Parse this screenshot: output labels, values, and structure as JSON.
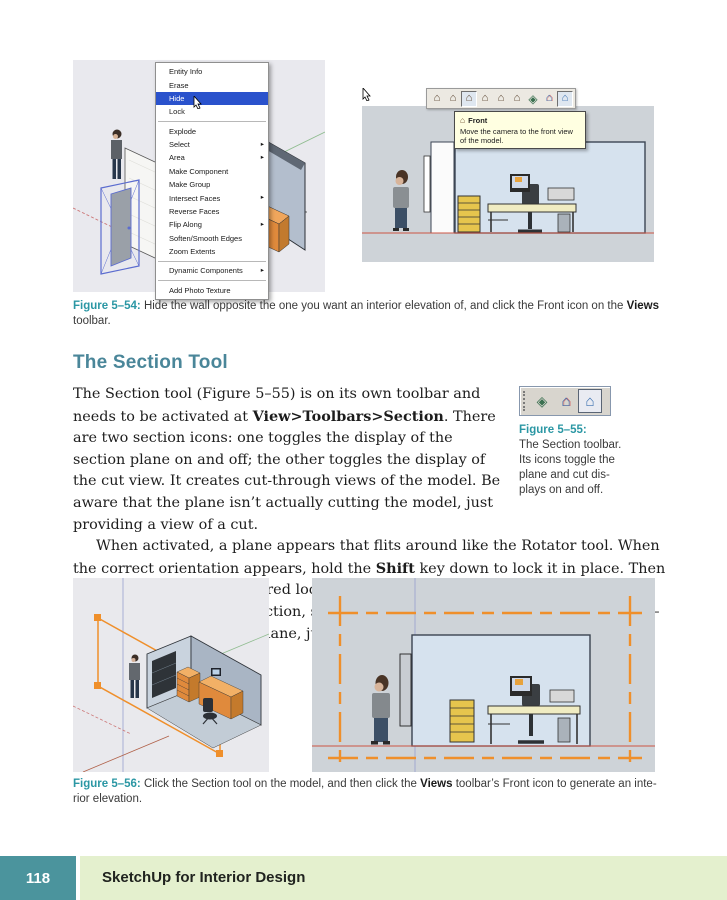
{
  "colors": {
    "accent_teal": "#2B97A4",
    "heading_teal": "#4A8699",
    "footer_teal": "#4B949D",
    "footer_green": "#E4F0CE",
    "menu_highlight": "#2A52CC",
    "tooltip_bg": "#FFFFE1",
    "section_plane_orange": "#EF8F2B",
    "desk_orange": "#E08A3C"
  },
  "figure54": {
    "context_menu": {
      "items": [
        {
          "label": "Entity Info"
        },
        {
          "label": "Erase"
        },
        {
          "label": "Hide",
          "highlighted": true
        },
        {
          "label": "Lock"
        },
        {
          "separator": true
        },
        {
          "label": "Explode"
        },
        {
          "label": "Select",
          "submenu": true
        },
        {
          "label": "Area",
          "submenu": true
        },
        {
          "label": "Make Component"
        },
        {
          "label": "Make Group"
        },
        {
          "label": "Intersect Faces",
          "submenu": true
        },
        {
          "label": "Reverse Faces"
        },
        {
          "label": "Flip Along",
          "submenu": true
        },
        {
          "label": "Soften/Smooth Edges"
        },
        {
          "label": "Zoom Extents"
        },
        {
          "separator": true
        },
        {
          "label": "Dynamic Components",
          "submenu": true
        },
        {
          "separator": true
        },
        {
          "label": "Add Photo Texture"
        }
      ]
    },
    "views_toolbar": {
      "icons": [
        {
          "name": "iso-view-icon",
          "glyph": "⌂"
        },
        {
          "name": "top-view-icon",
          "glyph": "⌂"
        },
        {
          "name": "front-view-icon",
          "glyph": "⌂",
          "pressed": true
        },
        {
          "name": "right-view-icon",
          "glyph": "⌂"
        },
        {
          "name": "back-view-icon",
          "glyph": "⌂"
        },
        {
          "name": "left-view-icon",
          "glyph": "⌂"
        },
        {
          "name": "section-plane-tool-icon",
          "glyph": "◈"
        },
        {
          "name": "display-section-planes-icon",
          "glyph": "⌂"
        },
        {
          "name": "display-section-cuts-icon",
          "glyph": "⌂",
          "pressed": true
        }
      ]
    },
    "tooltip": {
      "house_glyph": "⌂",
      "title": "Front",
      "body": "Move the camera to the front view of the model."
    },
    "caption": {
      "label": "Figure 5–54:",
      "runs": [
        {
          "t": " Hide the wall opposite the one you want an interior elevation of, and click the Front icon on the "
        },
        {
          "t": "Views",
          "b": true
        },
        {
          "t": " toolbar."
        }
      ]
    }
  },
  "section_tool": {
    "heading": "The Section Tool",
    "paragraph1": {
      "runs": [
        {
          "t": "The Section tool (Figure 5–55) is on its own toolbar and needs to be activated at "
        },
        {
          "t": "View>Toolbars>Section",
          "b": true
        },
        {
          "t": ". There are two section icons: one toggles the display of the section plane on and off; the other toggles the display of the cut view. It creates cut-through views of the model. Be aware that the plane isn’t actually cutting the model, just providing a view of a cut."
        }
      ]
    },
    "paragraph2": {
      "runs": [
        {
          "t": "When activated, a plane appears that flits around like the Rotator tool. When the correct orientation appears, hold the "
        },
        {
          "t": "Shift",
          "b": true
        },
        {
          "t": " key down to lock it in place. Then move the plane to the desired location and click in place (Figure 5–56). To change its location or direction, select it and activate Move or Rotate (Figure 5–57). To remove a section plane, just erase it."
        }
      ]
    }
  },
  "figure55": {
    "toolbar": {
      "icons": [
        {
          "name": "section-plane-tool-icon",
          "glyph": "◈"
        },
        {
          "name": "display-section-planes-icon",
          "glyph": "⌂"
        },
        {
          "name": "display-section-cuts-icon",
          "glyph": "⌂",
          "active": true
        }
      ]
    },
    "caption": {
      "label": "Figure 5–55:",
      "lines": [
        "The Section toolbar.",
        "Its icons toggle the",
        "plane and cut dis-",
        "plays on and off."
      ]
    }
  },
  "figure56": {
    "caption": {
      "label": "Figure 5–56:",
      "runs": [
        {
          "t": " Click the Section tool on the model, and then click the "
        },
        {
          "t": "Views",
          "b": true
        },
        {
          "t": " toolbar’s Front icon to generate an inte-"
        },
        {
          "t": "",
          "br": true
        },
        {
          "t": "rior elevation."
        }
      ]
    }
  },
  "footer": {
    "page_number": "118",
    "book_title": "SketchUp for Interior Design"
  }
}
